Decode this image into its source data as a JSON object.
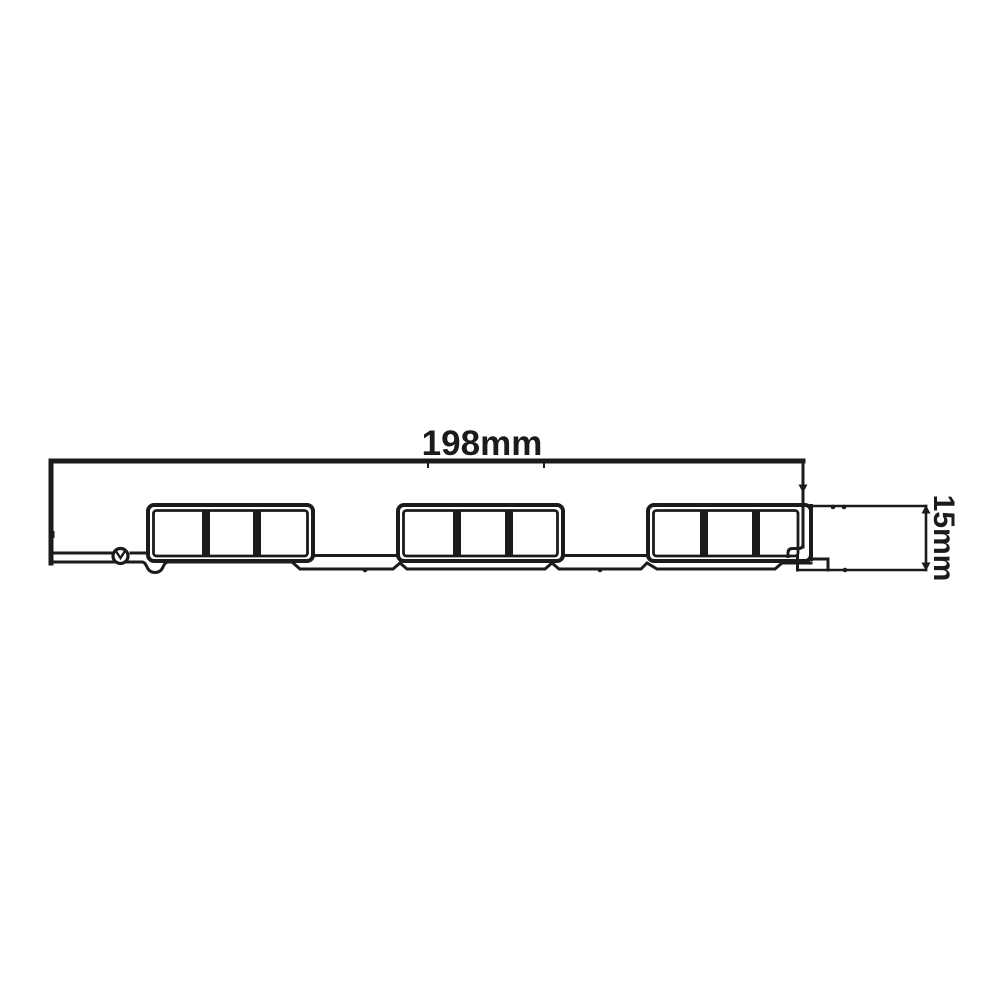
{
  "diagram": {
    "dimension_width": {
      "label": "198mm"
    },
    "dimension_height": {
      "label": "15mm"
    },
    "profile": {
      "chamber_groups": 3,
      "chambers_per_group": 3
    },
    "colors": {
      "line": "#1b1b1b",
      "background": "#ffffff"
    }
  }
}
